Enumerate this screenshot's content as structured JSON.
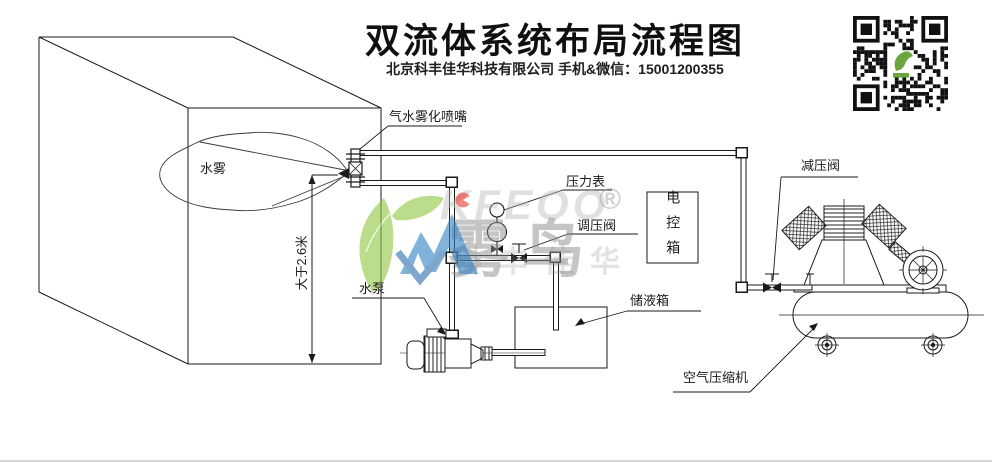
{
  "header": {
    "title": "双流体系统布局流程图",
    "subtitle": "北京科丰佳华科技有限公司 手机&微信：15001200355"
  },
  "labels": {
    "mist": "水雾",
    "min_height": "大于2.6米",
    "nozzle": "气水雾化喷嘴",
    "pressure_gauge": "压力表",
    "regulating_valve": "调压阀",
    "control_box": "电控箱",
    "water_pump": "水泵",
    "storage_tank": "储液箱",
    "reducing_valve": "减压阀",
    "air_compressor": "空气压缩机"
  },
  "watermark": {
    "latin": "KFEOO",
    "brand": "雾鸟",
    "registered": "®",
    "company": "科丰佳华"
  },
  "qr": {
    "name": "wechat-qr-code"
  },
  "colors": {
    "line": "#1a1a1a",
    "leaf_green": "#8dc63f",
    "logo_blue": "#2f7fc1",
    "logo_red": "#e8392f",
    "watermark_gray": "#8f8f8f",
    "qr_green": "#6aa63b"
  }
}
